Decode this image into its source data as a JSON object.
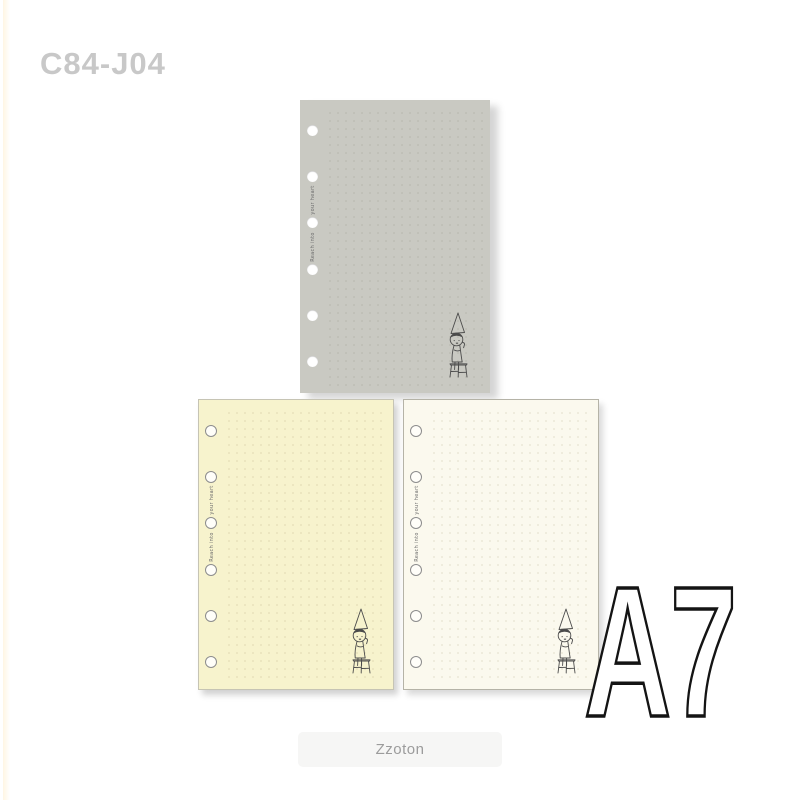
{
  "page": {
    "product_code": "C84-J04",
    "size_label": "A7",
    "brand_label": "Zzoton",
    "background": "#ffffff"
  },
  "sheet_text": {
    "upper": "your heart",
    "lower": "Reach into",
    "phrase": "Reach into your heart"
  },
  "sheets": [
    {
      "id": "gray",
      "paper_color": "#c9c9c2",
      "dot_color": "#bcbcb3",
      "holes": 6,
      "hole_style": "punched-white"
    },
    {
      "id": "cream",
      "paper_color": "#f7f3cd",
      "dot_color": "#e6e0b8",
      "holes": 6,
      "hole_style": "gray-ring"
    },
    {
      "id": "ivory",
      "paper_color": "#fbf9ee",
      "dot_color": "#e9e5d4",
      "holes": 6,
      "hole_style": "gray-ring"
    }
  ],
  "illustration": {
    "name": "girl-with-cone-hat-sitting-on-stool",
    "stroke_color": "#4b4b4b"
  },
  "colors": {
    "product_code_text": "#c8c8c8",
    "size_label_fill": "#ffffff",
    "size_label_stroke": "#141414",
    "brand_badge_bg": "#f6f6f5",
    "brand_badge_text": "#9c9c9c"
  }
}
